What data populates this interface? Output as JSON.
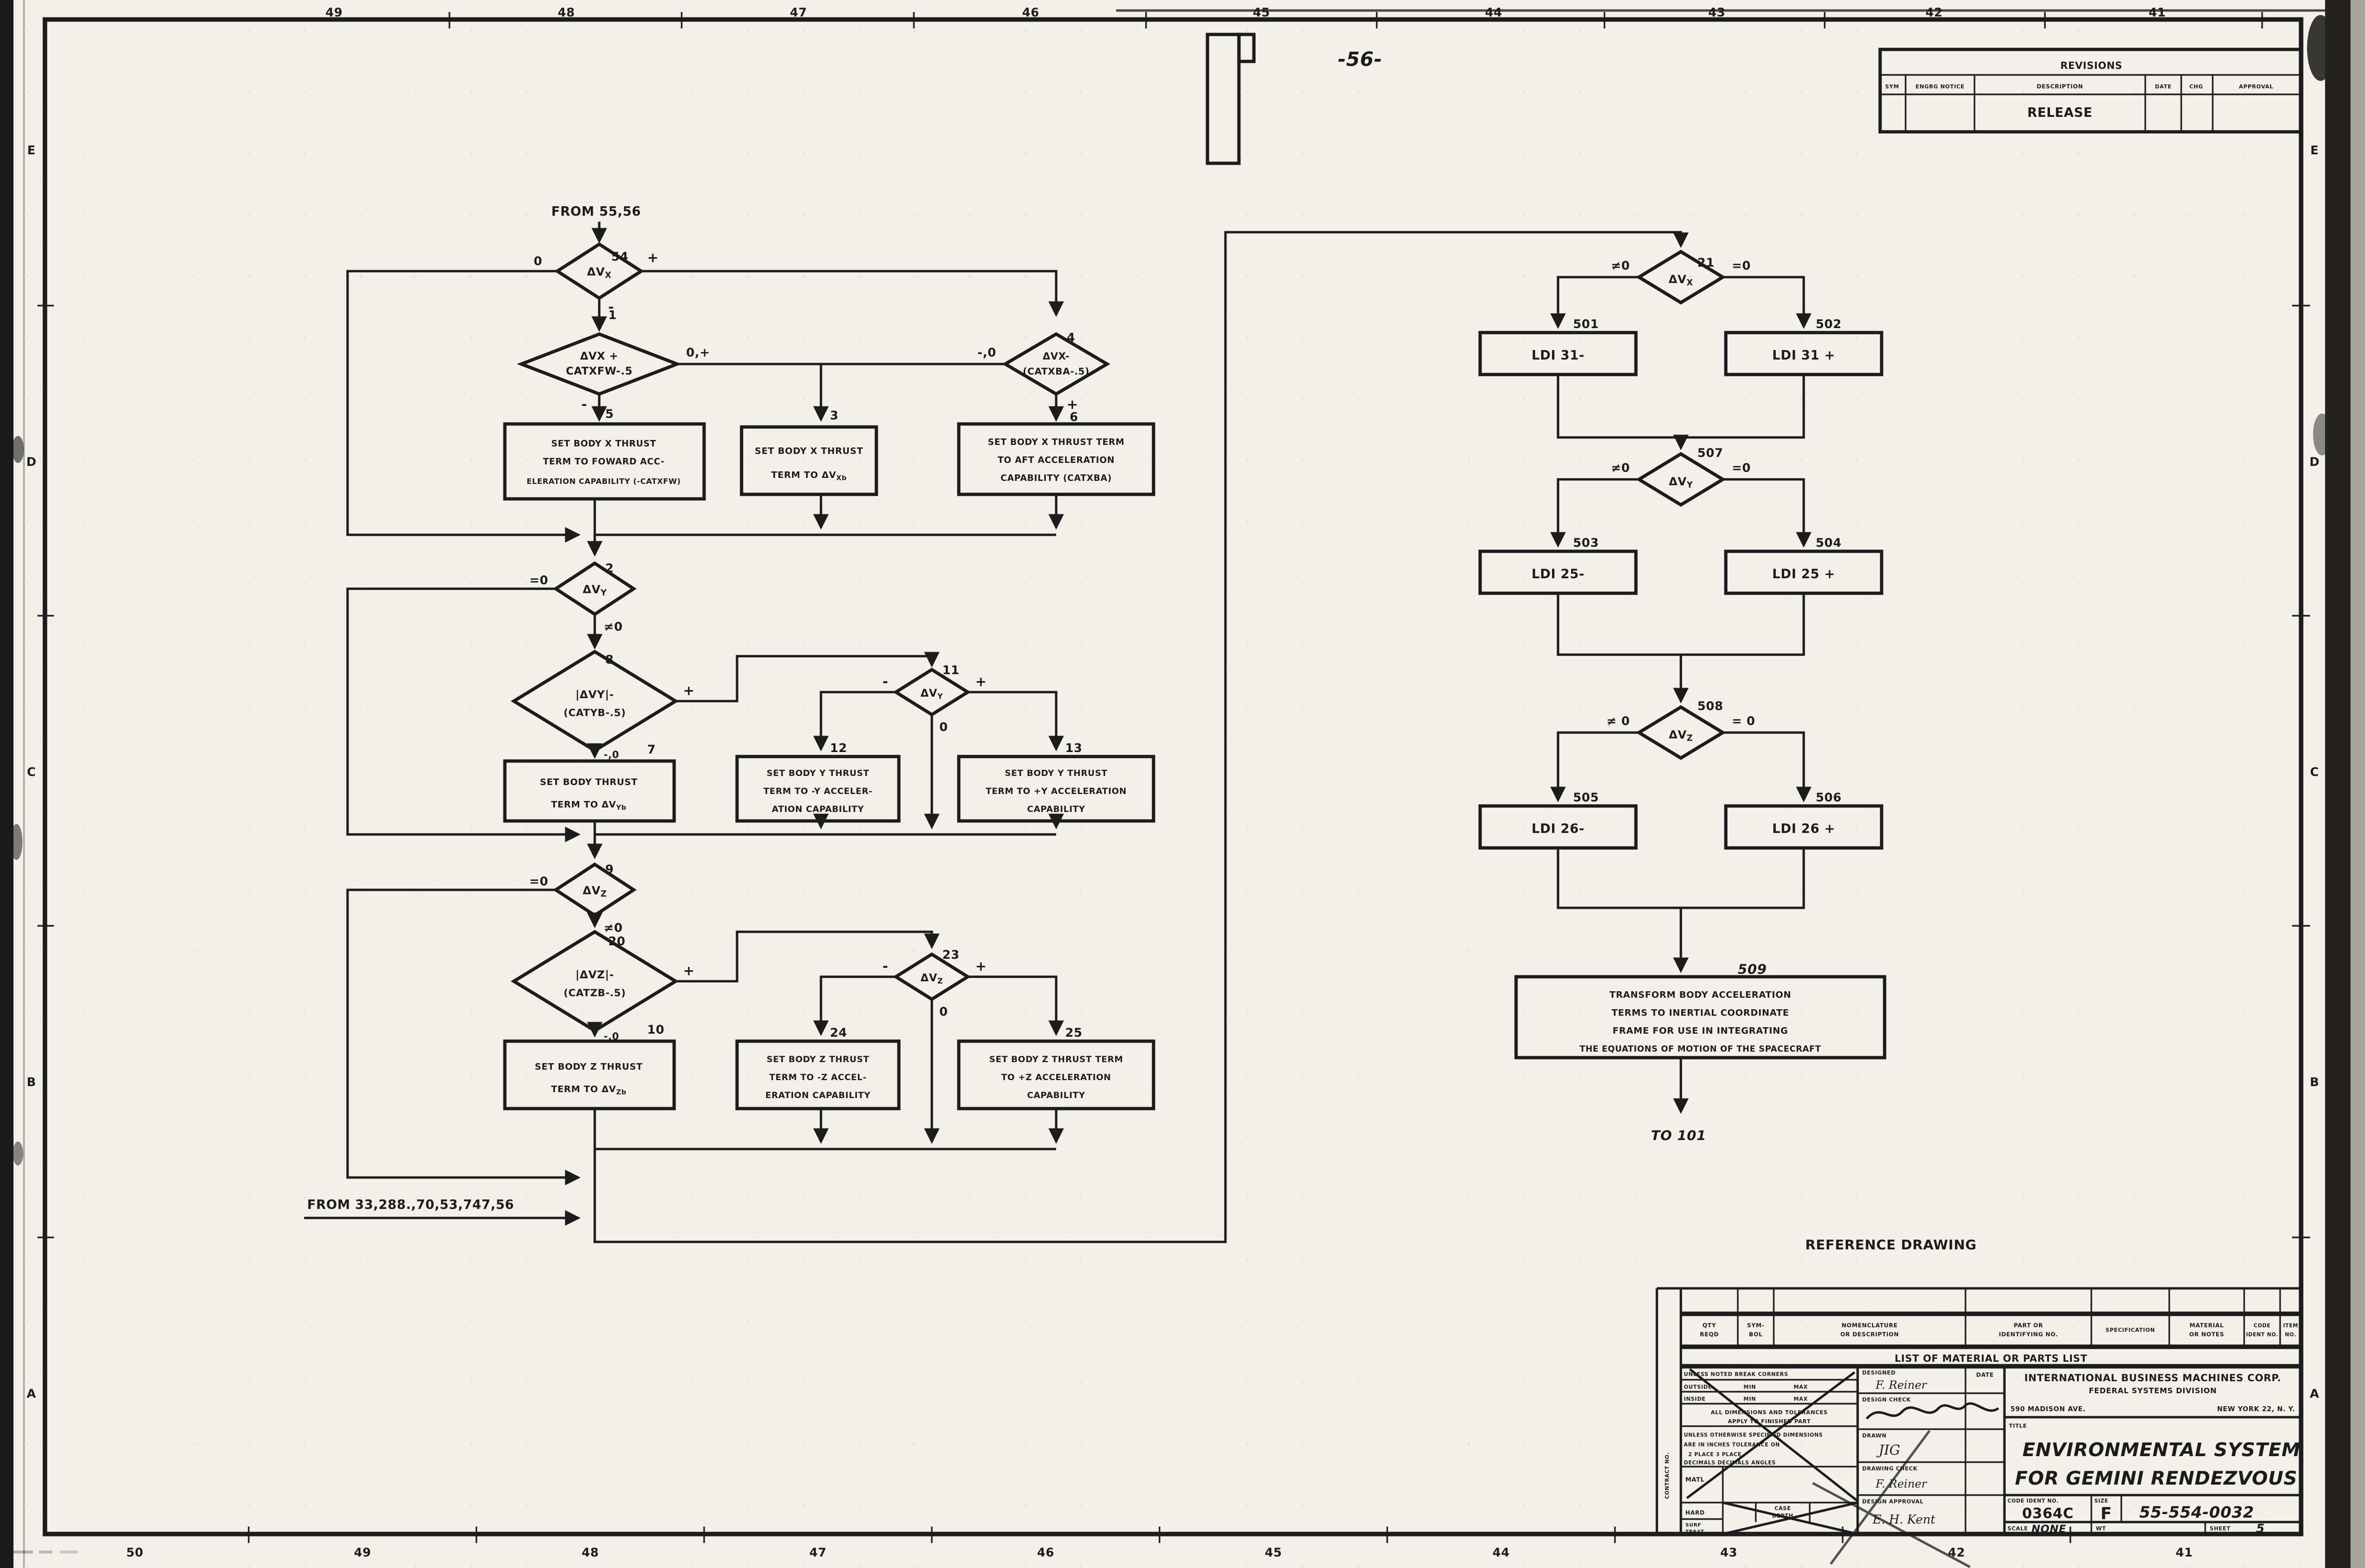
{
  "colors": {
    "ink": "#1c1c1c",
    "paper": "#f2f0e9"
  },
  "sheet": {
    "page_note": "-56-",
    "reference_note": "REFERENCE  DRAWING",
    "from_top_note": "FROM 55,56",
    "from_bottom_note": "FROM 33,288.,70,53,747,56",
    "to_note": "TO  101"
  },
  "zones": {
    "top": [
      "49",
      "48",
      "47",
      "46",
      "45",
      "44",
      "43",
      "42",
      "41"
    ],
    "bottom": [
      "50",
      "49",
      "48",
      "47",
      "46",
      "45",
      "44",
      "43",
      "42",
      "41"
    ],
    "left": [
      "E",
      "D",
      "C",
      "B",
      "A"
    ],
    "right": [
      "E",
      "D",
      "C",
      "B",
      "A"
    ]
  },
  "revisions": {
    "title": "REVISIONS",
    "col_sym": "SYM",
    "col_notice": "ENGRG NOTICE",
    "col_desc": "DESCRIPTION",
    "col_date": "DATE",
    "col_chg": "CHG",
    "col_approval": "APPROVAL",
    "row1_desc": "RELEASE"
  },
  "parts_list": {
    "title": "LIST OF MATERIAL OR PARTS LIST",
    "c1a": "QTY",
    "c1b": "REQD",
    "c2a": "SYM-",
    "c2b": "BOL",
    "c3a": "NOMENCLATURE",
    "c3b": "OR DESCRIPTION",
    "c4a": "PART OR",
    "c4b": "IDENTIFYING NO.",
    "c5": "SPECIFICATION",
    "c6a": "MATERIAL",
    "c6b": "OR NOTES",
    "c7a": "CODE",
    "c7b": "IDENT NO.",
    "c8a": "ITEM",
    "c8b": "NO."
  },
  "title_block": {
    "contract": "CONTRACT NO.",
    "break_corners": "UNLESS NOTED BREAK CORNERS",
    "outside": "OUTSIDE",
    "inside": "INSIDE",
    "min": "MIN",
    "max": "MAX",
    "alldim1": "ALL DIMENSIONS AND TOLERANCES",
    "alldim2": "APPLY TO FINISHED PART",
    "unless1": "UNLESS OTHERWISE SPECIFIED DIMENSIONS",
    "unless2": "ARE IN INCHES    TOLERANCE ON",
    "unless3": "2 PLACE         3 PLACE",
    "unless4": "DECIMALS    DECIMALS    ANGLES",
    "matl": "MATL",
    "hard": "HARD",
    "case1": "CASE",
    "case2": "DEPTH",
    "surf1": "SURF",
    "surf2": "TREAT",
    "designed": "DESIGNED",
    "designed_sig": "F. Reiner",
    "design_check": "DESIGN CHECK",
    "drawn": "DRAWN",
    "drawn_sig": "JIG",
    "drawing_check": "DRAWING CHECK",
    "drawing_check_sig": "F. Reiner",
    "design_approval": "DESIGN APPROVAL",
    "design_approval_sig": "E. H. Kent",
    "date": "DATE",
    "company1": "INTERNATIONAL BUSINESS MACHINES CORP.",
    "company2": "FEDERAL SYSTEMS DIVISION",
    "addr_left": "590 MADISON AVE.",
    "addr_right": "NEW YORK 22, N. Y.",
    "title_label": "TITLE",
    "title1": "ENVIRONMENTAL  SYSTEM",
    "title2": "FOR  GEMINI  RENDEZVOUS",
    "code_ident_label": "CODE IDENT NO.",
    "code_ident": "0364C",
    "size_label": "SIZE",
    "size": "F",
    "drawing_no": "55-554-0032",
    "scale_label": "SCALE",
    "scale": "NONE",
    "wt_label": "WT",
    "sheet_label": "SHEET",
    "sheet": "5"
  },
  "fc": {
    "n1": "1",
    "d54": {
      "num": "54",
      "base": "ΔV",
      "sub": "X",
      "left": "0",
      "right": "+",
      "bottom": "-"
    },
    "d1": {
      "l1": "ΔVX +",
      "l2": "CATXFW-.5",
      "right": "0,+",
      "bottom": "-"
    },
    "d4": {
      "num": "4",
      "l1": "ΔVX-",
      "l2": "(CATXBA-.5)",
      "left": "-,0",
      "bottom": "+"
    },
    "b5": {
      "num": "5",
      "l1": "SET BODY X THRUST",
      "l2": "TERM TO FOWARD ACC-",
      "l3": "ELERATION CAPABILITY (-CATXFW)"
    },
    "b3": {
      "num": "3",
      "l1": "SET BODY X THRUST",
      "l2a": "TERM TO ΔV",
      "l2b": "Xb"
    },
    "b6": {
      "num": "6",
      "l1": "SET BODY X THRUST TERM",
      "l2": "TO AFT ACCELERATION",
      "l3": "CAPABILITY (CATXBA)"
    },
    "d2": {
      "num": "2",
      "base": "ΔV",
      "sub": "Y",
      "left": "=0",
      "bottom": "≠0"
    },
    "d8": {
      "num": "8",
      "l1": "|ΔVY|-",
      "l2": "(CATYB-.5)",
      "right": "+",
      "bottom": "-,0"
    },
    "d11": {
      "num": "11",
      "base": "ΔV",
      "sub": "Y",
      "left": "-",
      "right": "+",
      "bottom": "0"
    },
    "b7": {
      "num": "7",
      "l1": "SET BODY  THRUST",
      "l2a": "TERM TO ΔV",
      "l2b": "Yb"
    },
    "b12": {
      "num": "12",
      "l1": "SET BODY Y THRUST",
      "l2": "TERM TO -Y ACCELER-",
      "l3": "ATION CAPABILITY"
    },
    "b13": {
      "num": "13",
      "l1": "SET BODY Y THRUST",
      "l2": "TERM TO +Y ACCELERATION",
      "l3": "CAPABILITY"
    },
    "d9": {
      "num": "9",
      "base": "ΔV",
      "sub": "Z",
      "left": "=0",
      "bottom": "≠0"
    },
    "d20": {
      "num": "20",
      "l1": "|ΔVZ|-",
      "l2": "(CATZB-.5)",
      "right": "+",
      "bottom": "-,0"
    },
    "d23": {
      "num": "23",
      "base": "ΔV",
      "sub": "Z",
      "left": "-",
      "right": "+",
      "bottom": "0"
    },
    "b10": {
      "num": "10",
      "l1": "SET BODY Z THRUST",
      "l2a": "TERM TO ΔV",
      "l2b": "Zb"
    },
    "b24": {
      "num": "24",
      "l1": "SET BODY Z THRUST",
      "l2": "TERM TO -Z ACCEL-",
      "l3": "ERATION CAPABILITY"
    },
    "b25": {
      "num": "25",
      "l1": "SET BODY Z THRUST TERM",
      "l2": "TO +Z ACCELERATION",
      "l3": "CAPABILITY"
    },
    "d21": {
      "num": "21",
      "base": "ΔV",
      "sub": "X",
      "left": "≠0",
      "right": "=0"
    },
    "b501": {
      "num": "501",
      "label": "LDI 31-"
    },
    "b502": {
      "num": "502",
      "label": "LDI 31 +"
    },
    "d507": {
      "num": "507",
      "base": "ΔV",
      "sub": "Y",
      "left": "≠0",
      "right": "=0"
    },
    "b503": {
      "num": "503",
      "label": "LDI 25-"
    },
    "b504": {
      "num": "504",
      "label": "LDI 25 +"
    },
    "d508": {
      "num": "508",
      "base": "ΔV",
      "sub": "Z",
      "left": "≠ 0",
      "right": "= 0"
    },
    "b505": {
      "num": "505",
      "label": "LDI 26-"
    },
    "b506": {
      "num": "506",
      "label": "LDI 26 +"
    },
    "b509": {
      "num": "509",
      "l1": "TRANSFORM  BODY  ACCELERATION",
      "l2": "TERMS TO INERTIAL  COORDINATE",
      "l3": "FRAME  FOR USE IN  INTEGRATING",
      "l4": "THE EQUATIONS OF MOTION OF THE SPACECRAFT"
    }
  }
}
